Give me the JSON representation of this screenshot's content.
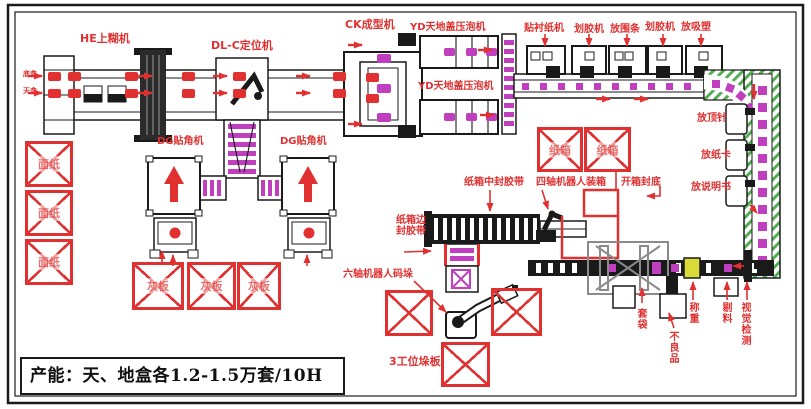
{
  "capacity": {
    "text": "产能：天、地盒各1.2-1.5万套/10H"
  },
  "labels": {
    "he": "HE上糊机",
    "dlc": "DL-C定位机",
    "ck": "CK成型机",
    "yd_top": "YD天地盖压泡机",
    "yd_bottom": "YD天地盖压泡机",
    "tiechenzhi": "贴衬纸机",
    "huajiaoji1": "划胶机",
    "fangweitiao": "放围条",
    "huajiaoji2": "划胶机",
    "fangxisu": "放吸塑",
    "fangdingzhen": "放顶针",
    "fangzhika": "放纸卡",
    "fangshuomingshu": "放说明书",
    "dg_left": "DG贴角机",
    "dg_right": "DG贴角机",
    "zhongfengjiaodai": "纸箱中封胶带",
    "sizhou_zhuangxiang": "四轴机器人装箱",
    "kaixiangfengdi": "开箱封底",
    "bianfengjiaodai": "纸箱边封胶带",
    "liuzhou_maduo": "六轴机器人码垛",
    "gongwei_duoban": "3工位垛板",
    "taodai": "套袋",
    "buliangpin": "不良品",
    "chengzhong": "称重",
    "tiliao": "剔料",
    "shijue_jiance": "视觉检测",
    "di_he": "底盒",
    "tian_he": "天盒"
  },
  "storage": [
    {
      "label": "面纸"
    },
    {
      "label": "面纸"
    },
    {
      "label": "面纸"
    },
    {
      "label": "灰板"
    },
    {
      "label": "灰板"
    },
    {
      "label": "灰板"
    },
    {
      "label": "纸箱"
    },
    {
      "label": "纸箱"
    },
    {
      "label": ""
    },
    {
      "label": ""
    },
    {
      "label": ""
    }
  ],
  "colors": {
    "label_red": "#e03030",
    "conveyor_magenta": "#bf3fbf",
    "hatch_green": "#54ae54",
    "line_black": "#1a1a1a",
    "weigh_yellow": "#d9d93a"
  }
}
